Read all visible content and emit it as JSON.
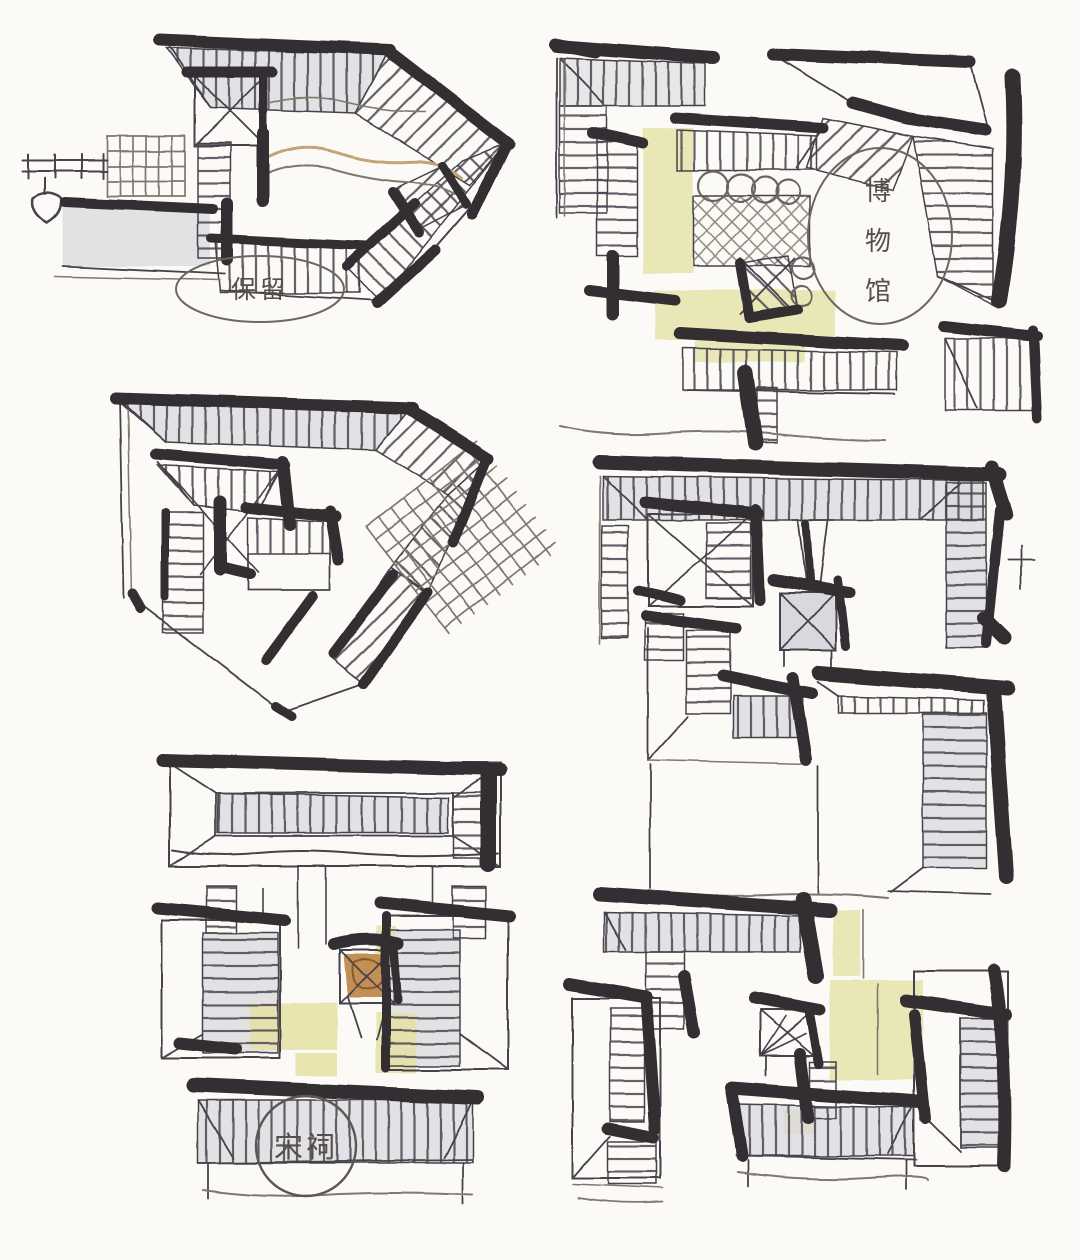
{
  "page": {
    "kind": "hand-drawn architectural sketch sheet",
    "paper_color": "#fbfaf6"
  },
  "annotations": {
    "preserve_label": "保留",
    "museum_label": "博物馆",
    "museum_chars": [
      "博",
      "物",
      "馆"
    ],
    "hall_label": "宋祠"
  },
  "colors": {
    "ink_heavy": "#322d30",
    "ink_line": "#46424b",
    "ink_light": "#7d7870",
    "hatch_line": "#4a4550",
    "trellis_line": "#8a8376",
    "wash_gray": "#d9dade",
    "wash_yellow": "#e5e2a6",
    "wash_tan": "#c2a477",
    "pavilion_orange": "#bf8a4d",
    "pavilion_gray": "#d4d5da",
    "label_ink": "#554f49"
  }
}
